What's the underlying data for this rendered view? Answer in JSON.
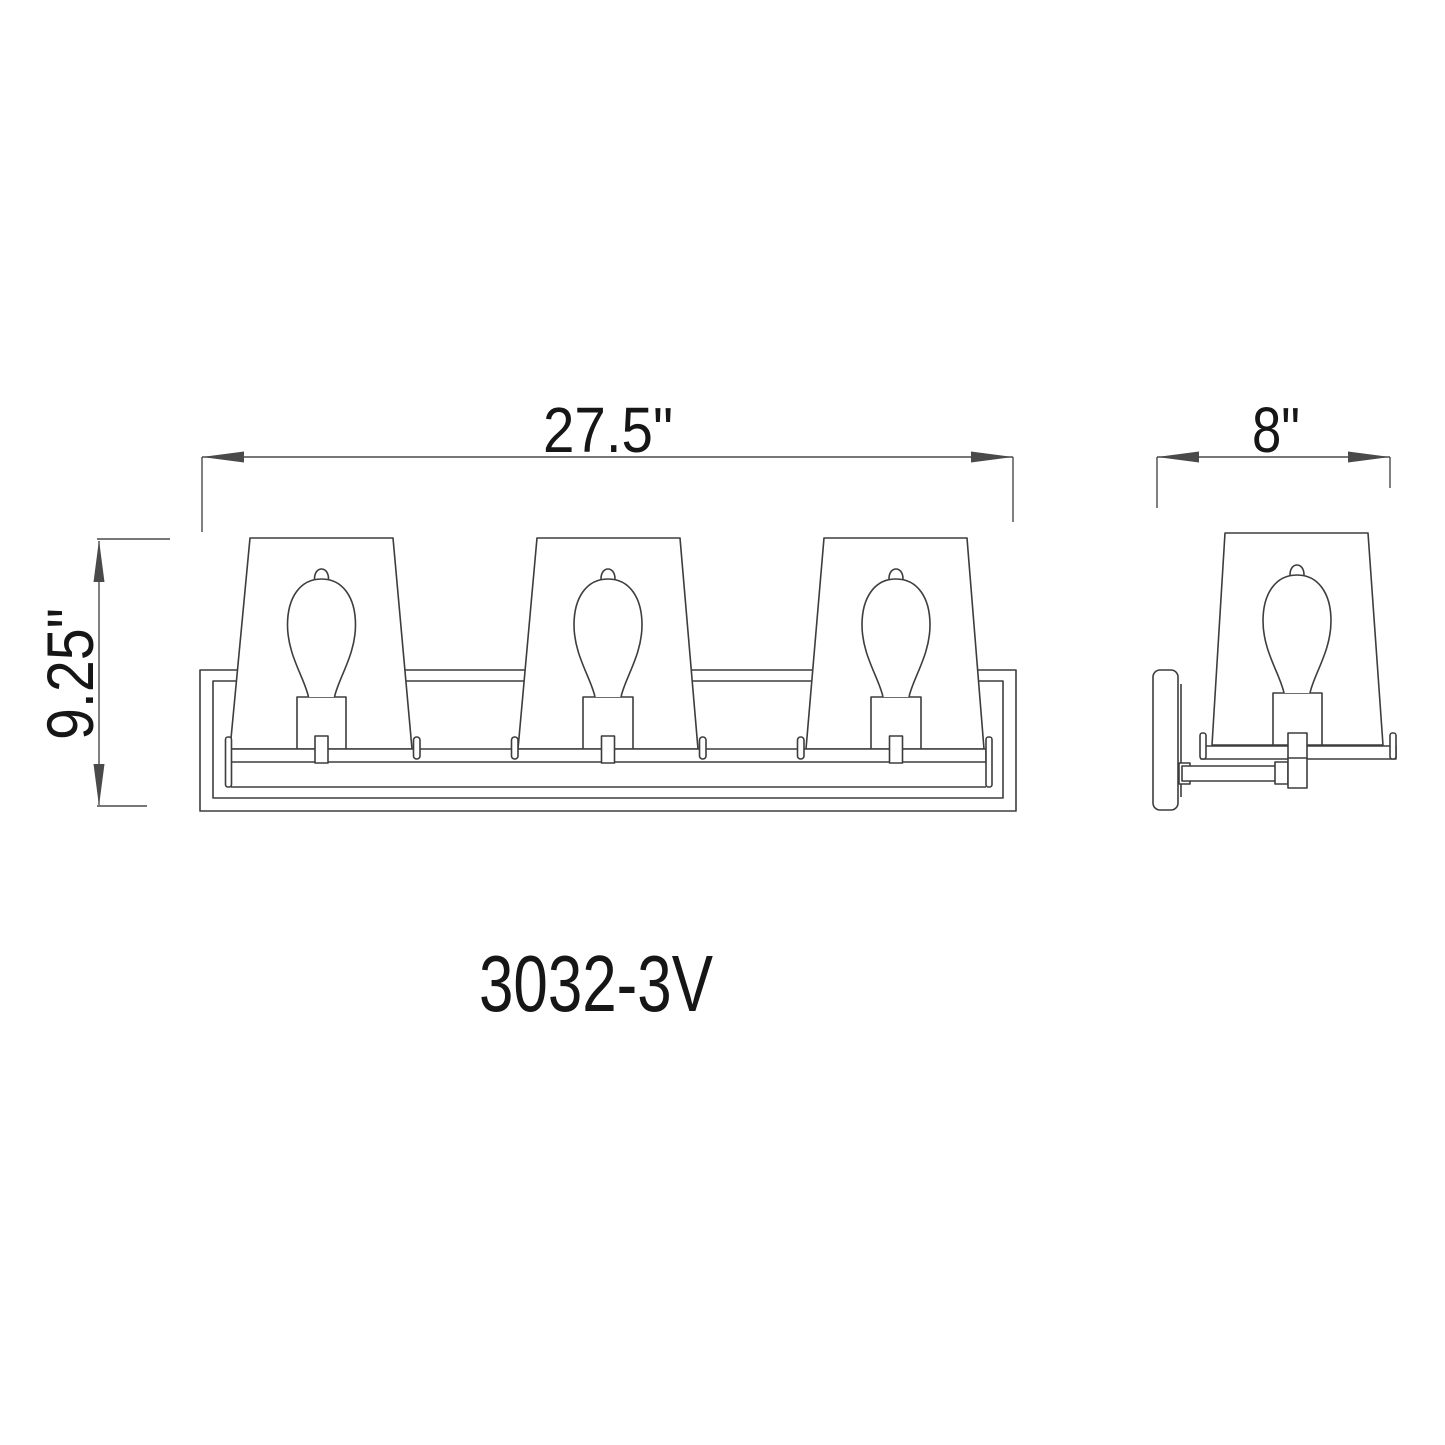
{
  "drawing": {
    "model_label": "3032-3V",
    "dimensions": {
      "front_width": "27.5\"",
      "front_height": "9.25\"",
      "side_depth": "8\""
    }
  },
  "theme": {
    "ink": "#3d3d3d",
    "dim_ink": "#4a4a4a",
    "text_ink": "#161616",
    "paper": "#ffffff"
  }
}
